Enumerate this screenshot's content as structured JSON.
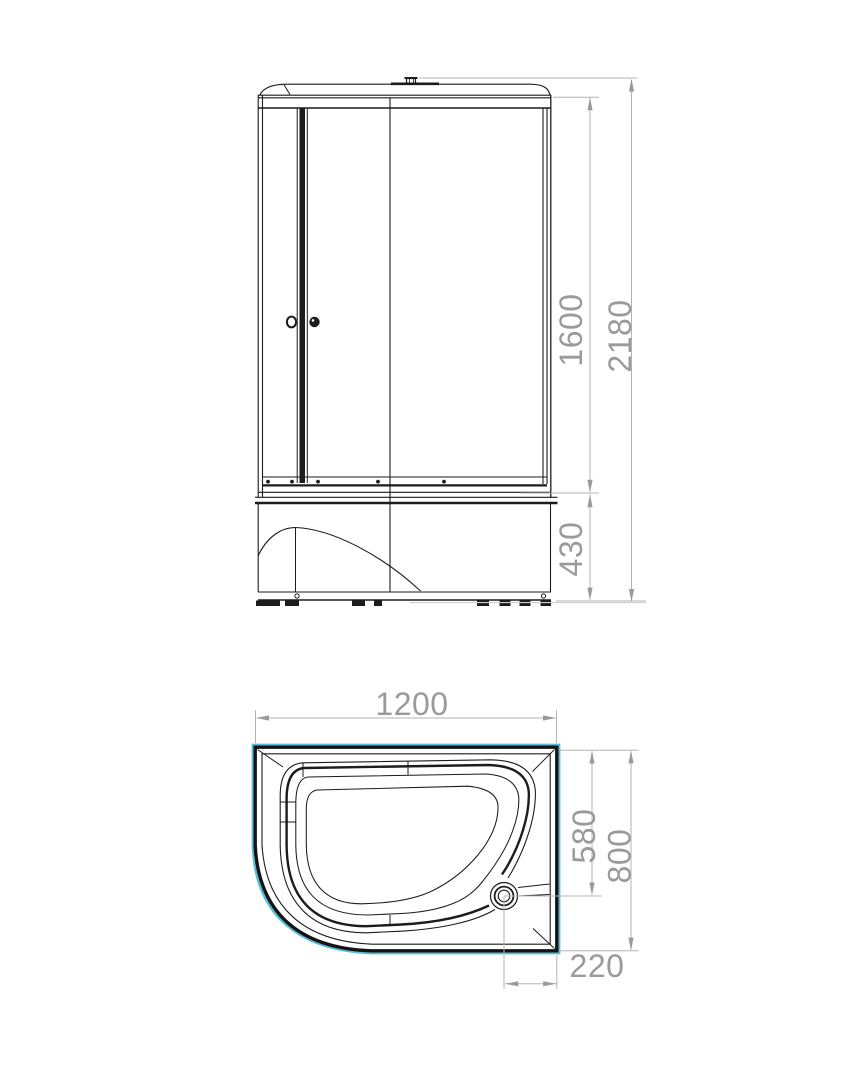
{
  "drawing_title": "shower-cabin-dimension-drawing",
  "front_view": {
    "glass_height": "1600",
    "total_height": "2180",
    "tray_height": "430"
  },
  "plan_view": {
    "width": "1200",
    "drain_offset_depth": "580",
    "depth": "800",
    "drain_offset_side": "220"
  },
  "colors": {
    "line": "#1c1c1c",
    "dimension": "#9a9a9a",
    "tray_edge_accent": "#5abcd6"
  }
}
